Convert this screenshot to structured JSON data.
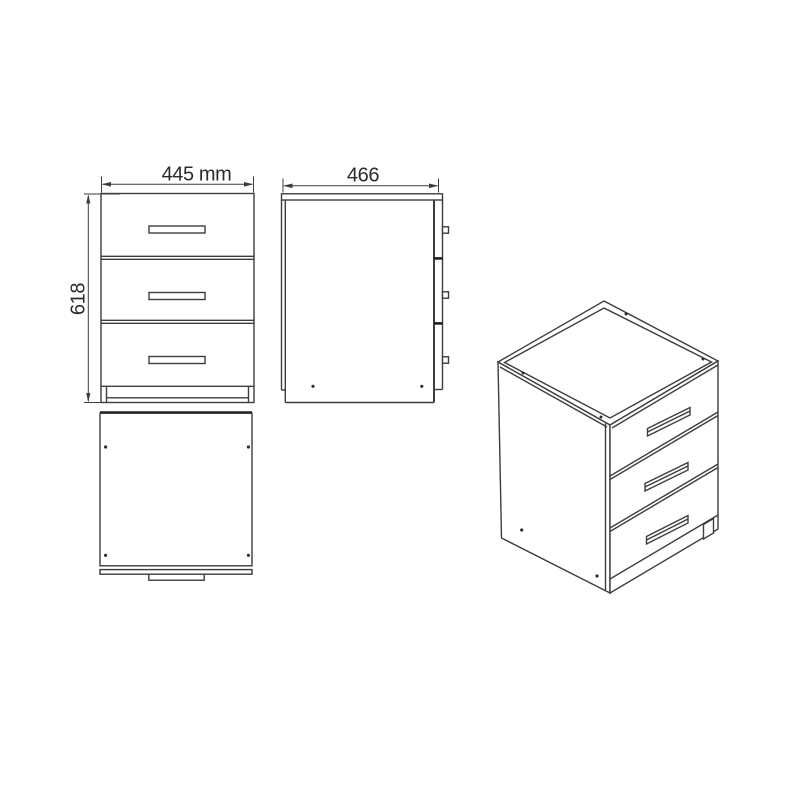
{
  "drawing": {
    "product": "three-drawer-cabinet-technical-drawing",
    "background_color": "#ffffff",
    "line_color": "#3d3d3d",
    "drawer_count": 3,
    "dimensions": {
      "width": "445 mm",
      "depth": "466",
      "height": "618"
    }
  }
}
